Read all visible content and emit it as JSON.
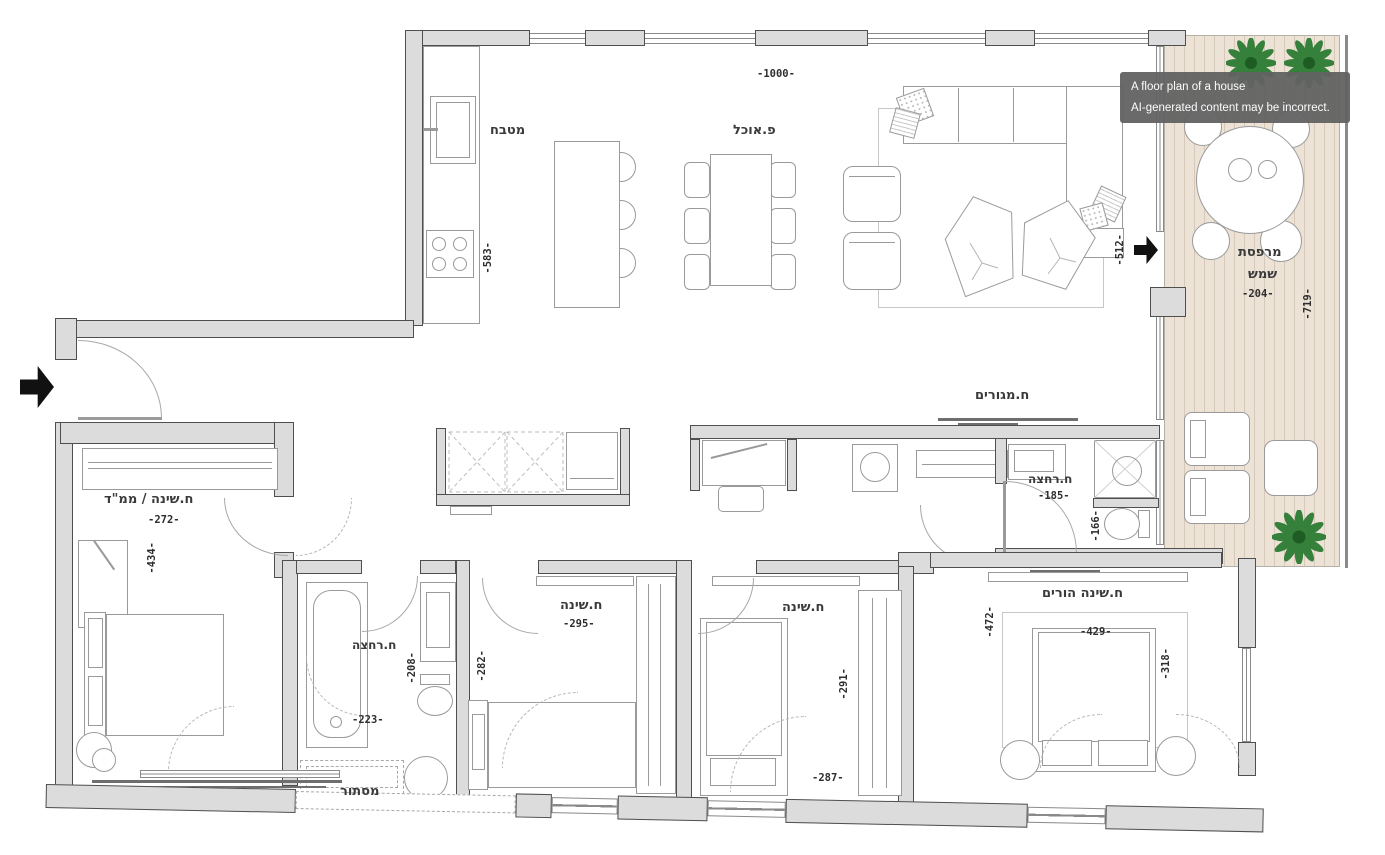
{
  "tooltip": {
    "line1": "A floor plan of a house",
    "line2": "AI-generated content may be incorrect."
  },
  "labels": {
    "kitchen": "מטבח",
    "dining": "פ.אוכל",
    "living": "ח.מגורים",
    "balcony_line1": "מרפסת",
    "balcony_line2": "שמש",
    "mamad_bedroom": "ח.שינה / ממ\"ד",
    "bath_main": "ח.רחצה",
    "bath_small": "ח.רחצה",
    "bedroom_a": "ח.שינה",
    "bedroom_b": "ח.שינה",
    "parents_bedroom": "ח.שינה הורים",
    "mistor": "מסתור"
  },
  "dims": {
    "top_width": "-1000-",
    "kitchen_height": "-583-",
    "living_height": "-512-",
    "balcony_width": "-204-",
    "balcony_height": "-719-",
    "mamad_width": "-272-",
    "mamad_height": "-434-",
    "bath_main_width": "-185-",
    "wc_height": "-166-",
    "bedroom_a_width": "-295-",
    "bedroom_a_height": "-282-",
    "bath_small_height": "-208-",
    "bath_small_width": "-223-",
    "bedroom_b_height": "-291-",
    "bedroom_b_width": "-287-",
    "parents_height": "-472-",
    "parents_bed_width": "-429-",
    "parents_bed_height": "-318-"
  },
  "colors": {
    "wall_fill": "#dcdcdc",
    "wall_stroke": "#4f4f4f",
    "deck_fill": "#ece2d6",
    "deck_line": "#d6c9ba",
    "plant_green": "#35803a",
    "arrow_black": "#111111",
    "tooltip_bg": "#676767",
    "text_color": "#2e2e2e"
  }
}
